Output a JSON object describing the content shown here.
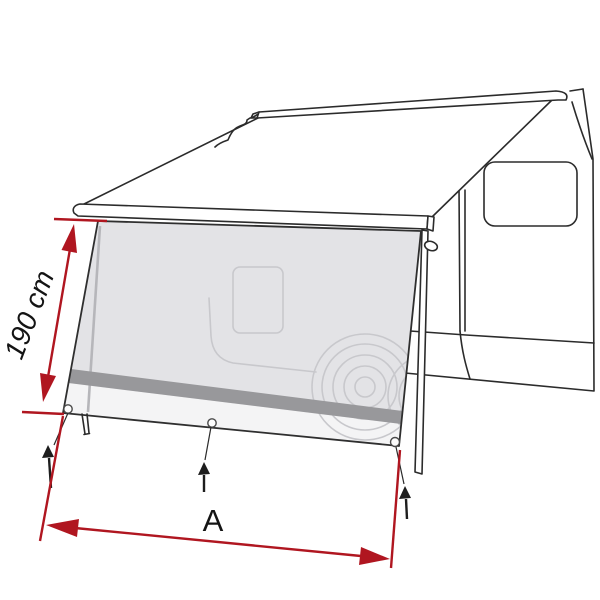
{
  "diagram": {
    "subject": "awning-front-panel-dimension-diagram",
    "height_dimension": {
      "label": "190 cm"
    },
    "width_dimension": {
      "label": "A"
    },
    "elements": {
      "grommets": 3,
      "ground_pegs": 3,
      "support_legs": 2
    }
  },
  "colors": {
    "dimension_red": "#b01620",
    "line_black": "#2b2b2b",
    "mesh_gray": "#e3e3e6",
    "band_gray": "#98989b",
    "hem_gray": "#f4f4f5",
    "silhouette_gray": "#c8c8cc",
    "background": "#ffffff"
  }
}
